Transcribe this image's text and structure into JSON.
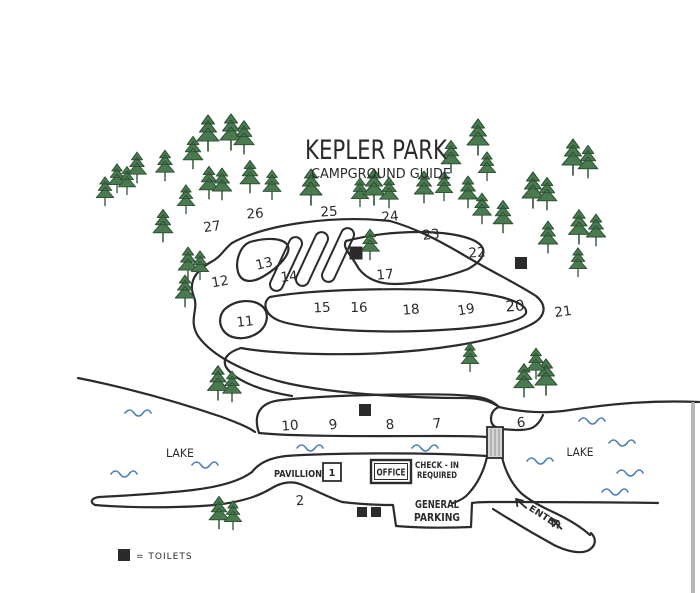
{
  "title": {
    "main": "KEPLER PARK",
    "subtitle": "CAMPGROUND GUIDE"
  },
  "labels": {
    "lake_left": "LAKE",
    "lake_right": "LAKE",
    "pavilion": "PAVILLION",
    "pavilion_box": "1",
    "office": "OFFICE",
    "checkin_line1": "CHECK - IN",
    "checkin_line2": "REQUIRED",
    "parking_line1": "GENERAL",
    "parking_line2": "PARKING",
    "enter": "ENTER",
    "legend": "= TOILETS"
  },
  "colors": {
    "ink": "#2b2b2b",
    "tree": "#4a7a50",
    "tree_outline": "#2e5233",
    "water": "#4a7fb5",
    "bridge": "#d6d6d6",
    "bridge_stripe": "#999999",
    "scrollbar": "#b7b7b7"
  },
  "map": {
    "sites": [
      {
        "n": "27",
        "x": 212,
        "y": 226,
        "r": -8
      },
      {
        "n": "26",
        "x": 255,
        "y": 213,
        "r": -4
      },
      {
        "n": "25",
        "x": 329,
        "y": 211,
        "r": -3
      },
      {
        "n": "24",
        "x": 390,
        "y": 216,
        "r": -5
      },
      {
        "n": "23",
        "x": 431,
        "y": 234,
        "r": -6
      },
      {
        "n": "22",
        "x": 477,
        "y": 252,
        "r": -4
      },
      {
        "n": "21",
        "x": 563,
        "y": 311,
        "r": -8
      },
      {
        "n": "20",
        "x": 515,
        "y": 306,
        "r": -4,
        "f": 15
      },
      {
        "n": "19",
        "x": 466,
        "y": 309,
        "r": -10
      },
      {
        "n": "18",
        "x": 411,
        "y": 309,
        "r": -5
      },
      {
        "n": "17",
        "x": 385,
        "y": 274,
        "r": -4
      },
      {
        "n": "16",
        "x": 359,
        "y": 307,
        "r": 0
      },
      {
        "n": "15",
        "x": 322,
        "y": 307,
        "r": -3
      },
      {
        "n": "14",
        "x": 289,
        "y": 276,
        "r": -6
      },
      {
        "n": "13",
        "x": 264,
        "y": 263,
        "r": -14
      },
      {
        "n": "12",
        "x": 220,
        "y": 281,
        "r": -10
      },
      {
        "n": "11",
        "x": 245,
        "y": 321,
        "r": -6
      },
      {
        "n": "10",
        "x": 290,
        "y": 425,
        "r": -5
      },
      {
        "n": "9",
        "x": 333,
        "y": 424,
        "r": -8
      },
      {
        "n": "8",
        "x": 390,
        "y": 424,
        "r": -4
      },
      {
        "n": "7",
        "x": 437,
        "y": 423,
        "r": -6
      },
      {
        "n": "6",
        "x": 521,
        "y": 422,
        "r": -6
      },
      {
        "n": "2",
        "x": 300,
        "y": 500,
        "r": -5
      }
    ],
    "toilets": [
      {
        "x": 356,
        "y": 253,
        "s": 13
      },
      {
        "x": 521,
        "y": 263,
        "s": 12
      },
      {
        "x": 365,
        "y": 410,
        "s": 12
      },
      {
        "x": 362,
        "y": 512,
        "s": 10
      },
      {
        "x": 376,
        "y": 512,
        "s": 10
      }
    ],
    "trees": [
      [
        105,
        204,
        0.8
      ],
      [
        117,
        191,
        0.8
      ],
      [
        127,
        193,
        0.78
      ],
      [
        137,
        181,
        0.85
      ],
      [
        165,
        179,
        0.85
      ],
      [
        193,
        167,
        0.9
      ],
      [
        208,
        149,
        1
      ],
      [
        231,
        148,
        1
      ],
      [
        244,
        152,
        0.92
      ],
      [
        209,
        197,
        0.9
      ],
      [
        222,
        198,
        0.88
      ],
      [
        250,
        191,
        0.9
      ],
      [
        272,
        198,
        0.82
      ],
      [
        186,
        212,
        0.8
      ],
      [
        311,
        203,
        1
      ],
      [
        360,
        205,
        0.8
      ],
      [
        374,
        203,
        1
      ],
      [
        389,
        206,
        0.85
      ],
      [
        451,
        171,
        0.9
      ],
      [
        478,
        153,
        1
      ],
      [
        487,
        179,
        0.8
      ],
      [
        573,
        173,
        1
      ],
      [
        588,
        176,
        0.9
      ],
      [
        424,
        201,
        0.88
      ],
      [
        444,
        199,
        0.8
      ],
      [
        468,
        206,
        0.88
      ],
      [
        533,
        206,
        1
      ],
      [
        547,
        208,
        0.9
      ],
      [
        482,
        222,
        0.85
      ],
      [
        503,
        231,
        0.9
      ],
      [
        548,
        251,
        0.88
      ],
      [
        579,
        242,
        0.95
      ],
      [
        596,
        244,
        0.88
      ],
      [
        578,
        275,
        0.8
      ],
      [
        163,
        240,
        0.9
      ],
      [
        188,
        277,
        0.88
      ],
      [
        200,
        278,
        0.8
      ],
      [
        185,
        305,
        0.88
      ],
      [
        370,
        258,
        0.85
      ],
      [
        218,
        398,
        0.95
      ],
      [
        232,
        400,
        0.85
      ],
      [
        470,
        370,
        0.8
      ],
      [
        524,
        395,
        0.92
      ],
      [
        546,
        393,
        1
      ],
      [
        536,
        377,
        0.85
      ],
      [
        219,
        527,
        0.9
      ],
      [
        233,
        528,
        0.8
      ]
    ],
    "waves": [
      [
        138,
        413
      ],
      [
        124,
        474
      ],
      [
        205,
        465
      ],
      [
        310,
        448
      ],
      [
        425,
        448
      ],
      [
        540,
        461
      ],
      [
        622,
        443
      ],
      [
        630,
        473
      ],
      [
        615,
        492
      ],
      [
        592,
        421
      ]
    ]
  }
}
